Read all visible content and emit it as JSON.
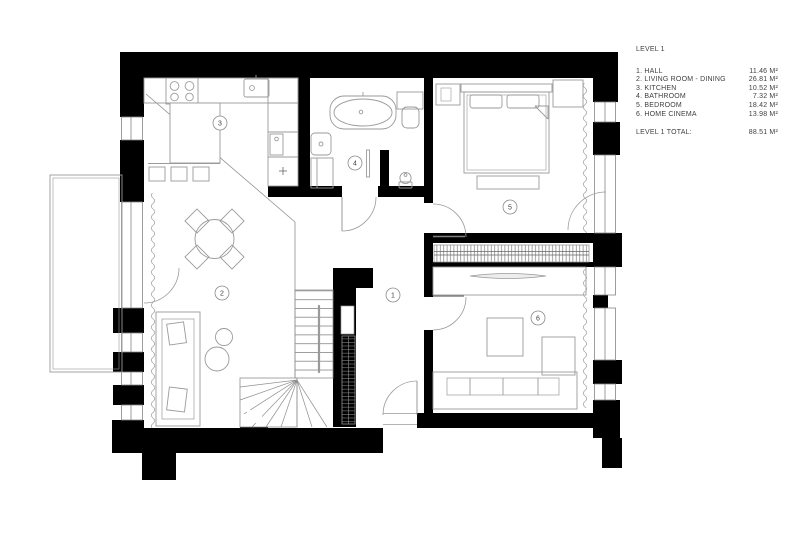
{
  "title": "LEVEL 1",
  "legend": {
    "rooms": [
      {
        "number": "1",
        "label": "1. HALL",
        "area": "11.46 M²"
      },
      {
        "number": "2",
        "label": "2. LIVING ROOM - DINING",
        "area": "26.81 M²"
      },
      {
        "number": "3",
        "label": "3. KITCHEN",
        "area": "10.52 M²"
      },
      {
        "number": "4",
        "label": "4. BATHROOM",
        "area": "7.32 M²"
      },
      {
        "number": "5",
        "label": "5. BEDROOM",
        "area": "18.42 M²"
      },
      {
        "number": "6",
        "label": "6. HOME CINEMA",
        "area": "13.98 M²"
      }
    ],
    "total_label": "LEVEL 1 TOTAL:",
    "total_area": "88.51 M²"
  },
  "colors": {
    "wall": "#000000",
    "line": "#9a9a9a",
    "text": "#3f3f3f"
  }
}
